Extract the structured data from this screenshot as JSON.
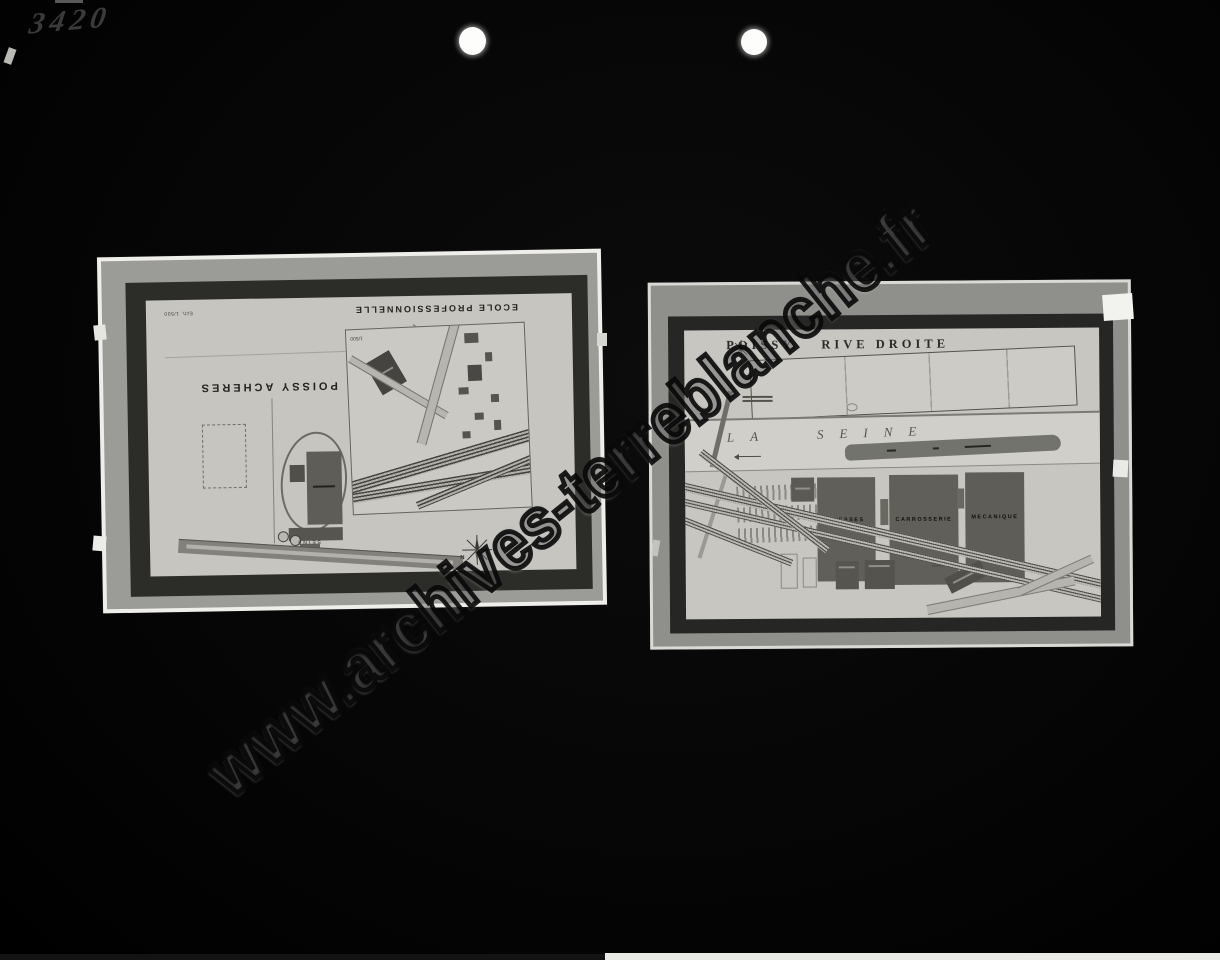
{
  "page": {
    "handwritten_number": "3420",
    "watermark": "www.archives-terreblanche.fr"
  },
  "left_photo": {
    "scale_note": "Ech. 1/500",
    "title": "POISSY  ACHERES",
    "river_label": "SEINE",
    "compass_label": "N",
    "inset": {
      "title": "ECOLE PROFESSIONNELLE",
      "scale": "1/500"
    }
  },
  "right_photo": {
    "title_city": "POISSY",
    "title_area": "RIVE DROITE",
    "river_label": "LA  SEINE",
    "buildings": [
      "PRESSES",
      "CARROSSERIE",
      "MECANIQUE"
    ]
  }
}
